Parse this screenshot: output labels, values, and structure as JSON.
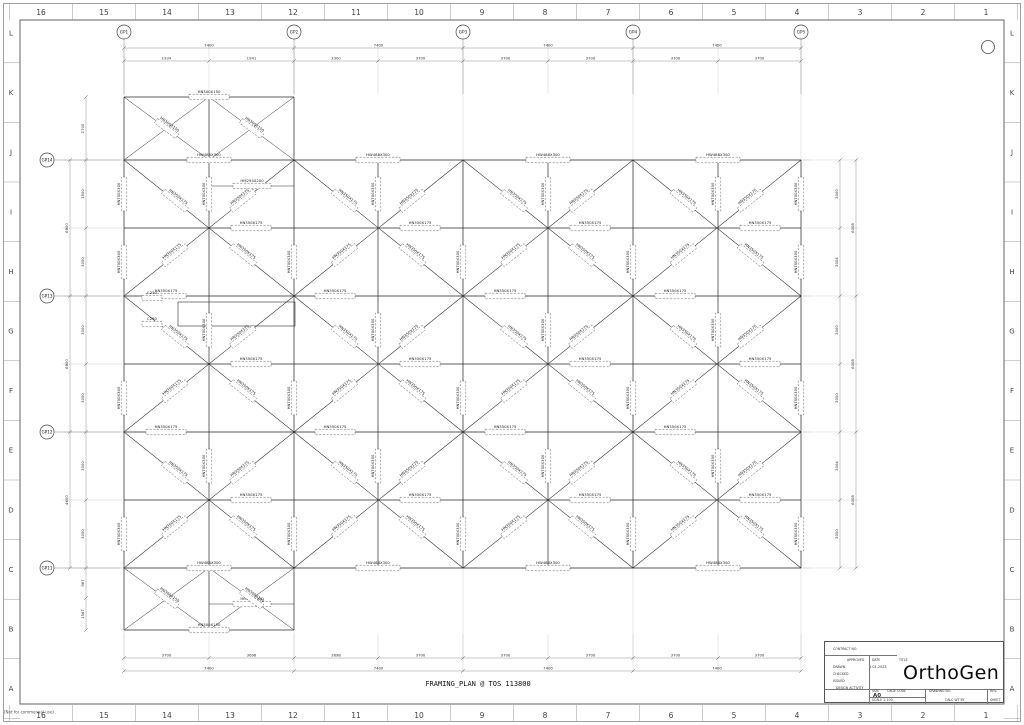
{
  "sheet": {
    "margin_numbers": [
      "16",
      "15",
      "14",
      "13",
      "12",
      "11",
      "10",
      "9",
      "8",
      "7",
      "6",
      "5",
      "4",
      "3",
      "2",
      "1"
    ],
    "margin_letters": [
      "L",
      "K",
      "J",
      "I",
      "H",
      "G",
      "F",
      "E",
      "D",
      "C",
      "B",
      "A"
    ],
    "footer_note": "(Not for commercial use)"
  },
  "plan": {
    "caption": "FRAMING_PLAN @ TOS 113800",
    "grid": {
      "cols_x": [
        124,
        209,
        294,
        378,
        463,
        548,
        633,
        718,
        801
      ],
      "rows_y": [
        160,
        228,
        296,
        364,
        432,
        500,
        568
      ],
      "top_edge_y": 97,
      "bottom_edge_y": 630,
      "bubble_cols": [
        124,
        294,
        463,
        633,
        801
      ],
      "bubble_rows": [
        160,
        296,
        432,
        568
      ]
    },
    "bubbles_top": [
      "GP1",
      "GP2",
      "GP3",
      "GP4",
      "GP5"
    ],
    "bubbles_left": [
      "GP14",
      "GP13",
      "GP12",
      "GP11"
    ],
    "sections": {
      "girder": "HW488X300",
      "beam": "HN350X175",
      "column": "HN700X300",
      "edge": "HN300X150",
      "infill": "HM294X200",
      "channel": "C250"
    },
    "dimensions": {
      "top_major": [
        "7400",
        "7400",
        "7400",
        "7400"
      ],
      "top_minor": [
        "1934",
        "1941",
        "3300",
        "3700",
        "3700",
        "3700",
        "3700",
        "3700"
      ],
      "bottom_minor": [
        "3700",
        "3696",
        "3698",
        "3700",
        "3700",
        "3700",
        "3700",
        "3700"
      ],
      "bottom_major": [
        "7400",
        "7400",
        "7400",
        "7400"
      ],
      "left_minor": [
        "1700",
        "1500",
        "3000",
        "3000",
        "3000",
        "3000",
        "3000",
        "967",
        "1567"
      ],
      "left_major": [
        "6800",
        "6800",
        "4600"
      ],
      "right_minor": [
        "3000",
        "3004",
        "3000",
        "3000",
        "3004",
        "3000"
      ],
      "right_major": [
        "6008",
        "6008",
        "6008"
      ]
    }
  },
  "title_block": {
    "contract_no_label": "CONTRACT NO.",
    "approved_label": "APPROVED",
    "date_label": "DATE",
    "title_label": "TITLE",
    "drawn_label": "DRAWN",
    "drawn_date": "5-01-2023",
    "checked_label": "CHECKED",
    "issued_label": "ISSUED",
    "design_activity_label": "DESIGN ACTIVITY",
    "size_label": "SIZE",
    "size_value": "A0",
    "cage_code_label": "CAGE CODE",
    "drawing_no_label": "DRAWING NO.",
    "rev_label": "REV.",
    "scale_label": "SCALE",
    "scale_value": "1:100",
    "calc_label": "CALC WT BY",
    "sheet_label": "SHEET",
    "logo": "OrthoGen"
  }
}
